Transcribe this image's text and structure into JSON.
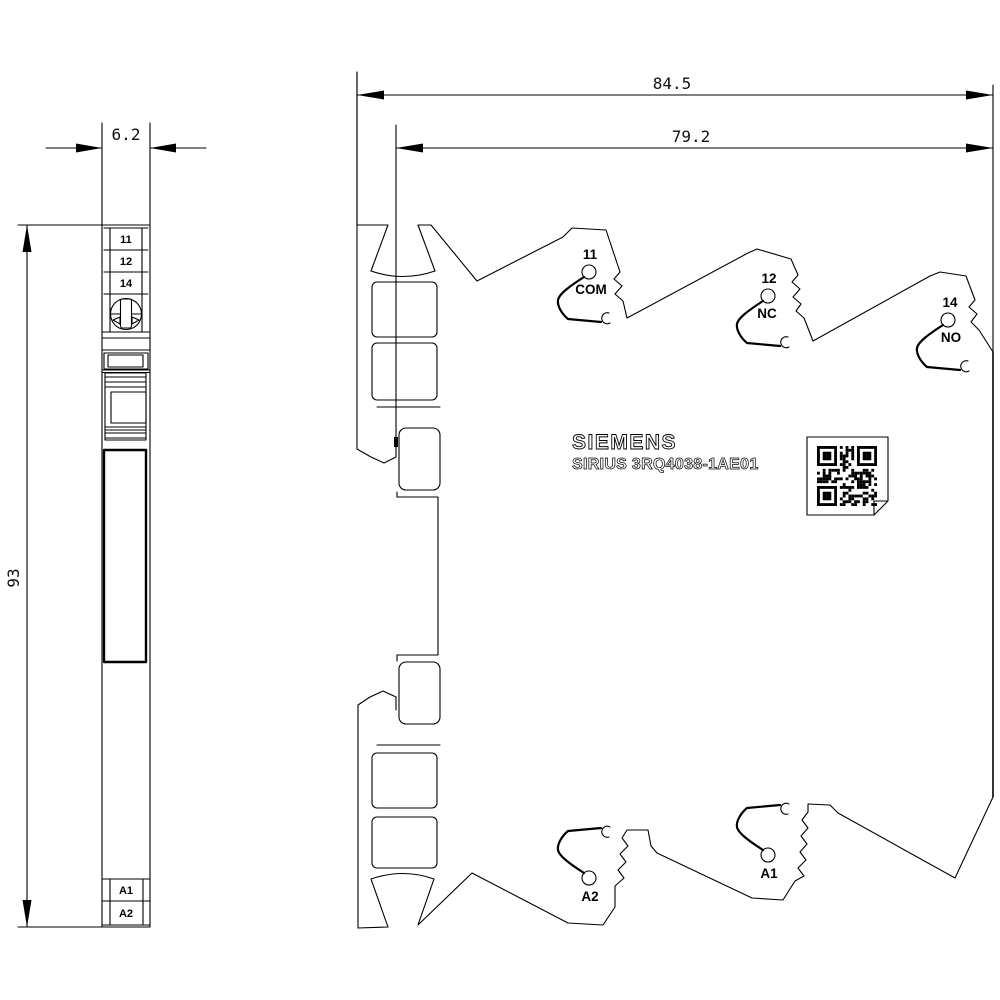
{
  "dims": {
    "overall_width": "84.5",
    "terminal_width": "79.2",
    "module_width": "6.2",
    "height": "93"
  },
  "views": {
    "side": {
      "terminals": [
        "11",
        "12",
        "14",
        "A1",
        "A2"
      ]
    },
    "front": {
      "brand": "SIEMENS",
      "model": "SIRIUS 3RQ4038-1AE01",
      "terminals": {
        "t11": {
          "id": "11",
          "fn": "COM"
        },
        "t12": {
          "id": "12",
          "fn": "NC"
        },
        "t14": {
          "id": "14",
          "fn": "NO"
        },
        "a2": {
          "id": "A2"
        },
        "a1": {
          "id": "A1"
        }
      }
    }
  },
  "colors": {
    "line": "#000000",
    "background": "#ffffff"
  }
}
